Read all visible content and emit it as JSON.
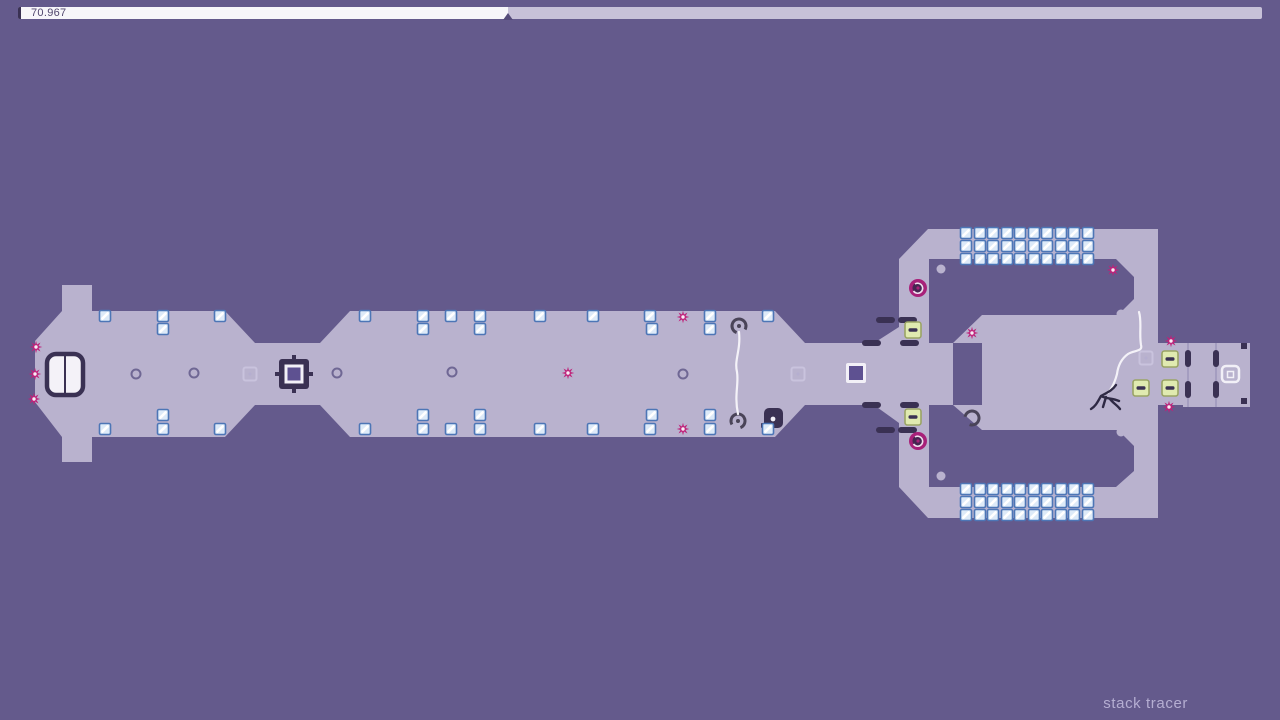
{
  "hud": {
    "timer": "70.967",
    "progress": 0.394
  },
  "level_name": "stack tracer",
  "colors": {
    "bg": "#645a8c",
    "terrain": "#b9b2ce",
    "dark": "#3a3153",
    "bar_fill": "#f7f6fa",
    "bar_rest": "#c7c1d8",
    "bar_text": "#51476e",
    "gold_fill": "#ddeaf8",
    "gold_border": "#4d76b6",
    "mine": "#bf2179",
    "green_fill": "#e0eab0",
    "green_border": "#9aa465",
    "drone_ring": "#a82079",
    "drone_core": "#452551",
    "trail": "#f4f2f8",
    "ninja": "#2e2944",
    "faint": "#c9c3dd",
    "ring_inner": "#5e5191",
    "name_color": "#b5aed2"
  },
  "entities": {
    "gold": [
      [
        105,
        316
      ],
      [
        163,
        316
      ],
      [
        220,
        316
      ],
      [
        365,
        316
      ],
      [
        423,
        316
      ],
      [
        451,
        316
      ],
      [
        480,
        316
      ],
      [
        540,
        316
      ],
      [
        593,
        316
      ],
      [
        650,
        316
      ],
      [
        710,
        316
      ],
      [
        768,
        316
      ],
      [
        163,
        329
      ],
      [
        423,
        329
      ],
      [
        480,
        329
      ],
      [
        652,
        329
      ],
      [
        710,
        329
      ],
      [
        105,
        429
      ],
      [
        163,
        429
      ],
      [
        220,
        429
      ],
      [
        365,
        429
      ],
      [
        423,
        429
      ],
      [
        451,
        429
      ],
      [
        480,
        429
      ],
      [
        540,
        429
      ],
      [
        593,
        429
      ],
      [
        650,
        429
      ],
      [
        710,
        429
      ],
      [
        768,
        429
      ],
      [
        163,
        415
      ],
      [
        423,
        415
      ],
      [
        480,
        415
      ],
      [
        652,
        415
      ],
      [
        710,
        415
      ],
      [
        966,
        233
      ],
      [
        980,
        233
      ],
      [
        993,
        233
      ],
      [
        1007,
        233
      ],
      [
        1020,
        233
      ],
      [
        1034,
        233
      ],
      [
        1047,
        233
      ],
      [
        1061,
        233
      ],
      [
        1074,
        233
      ],
      [
        1088,
        233
      ],
      [
        966,
        246
      ],
      [
        980,
        246
      ],
      [
        993,
        246
      ],
      [
        1007,
        246
      ],
      [
        1020,
        246
      ],
      [
        1034,
        246
      ],
      [
        1047,
        246
      ],
      [
        1061,
        246
      ],
      [
        1074,
        246
      ],
      [
        1088,
        246
      ],
      [
        966,
        259
      ],
      [
        980,
        259
      ],
      [
        993,
        259
      ],
      [
        1007,
        259
      ],
      [
        1020,
        259
      ],
      [
        1034,
        259
      ],
      [
        1047,
        259
      ],
      [
        1061,
        259
      ],
      [
        1074,
        259
      ],
      [
        1088,
        259
      ],
      [
        966,
        489
      ],
      [
        980,
        489
      ],
      [
        993,
        489
      ],
      [
        1007,
        489
      ],
      [
        1020,
        489
      ],
      [
        1034,
        489
      ],
      [
        1047,
        489
      ],
      [
        1061,
        489
      ],
      [
        1074,
        489
      ],
      [
        1088,
        489
      ],
      [
        966,
        502
      ],
      [
        980,
        502
      ],
      [
        993,
        502
      ],
      [
        1007,
        502
      ],
      [
        1020,
        502
      ],
      [
        1034,
        502
      ],
      [
        1047,
        502
      ],
      [
        1061,
        502
      ],
      [
        1074,
        502
      ],
      [
        1088,
        502
      ],
      [
        966,
        515
      ],
      [
        980,
        515
      ],
      [
        993,
        515
      ],
      [
        1007,
        515
      ],
      [
        1020,
        515
      ],
      [
        1034,
        515
      ],
      [
        1047,
        515
      ],
      [
        1061,
        515
      ],
      [
        1074,
        515
      ],
      [
        1088,
        515
      ]
    ],
    "mines": [
      [
        36,
        347
      ],
      [
        35,
        374
      ],
      [
        34,
        399
      ],
      [
        568,
        373
      ],
      [
        683,
        317
      ],
      [
        683,
        429
      ],
      [
        972,
        333
      ],
      [
        1113,
        270
      ],
      [
        1171,
        341
      ],
      [
        1169,
        407
      ]
    ],
    "circle_switches": [
      [
        136,
        374
      ],
      [
        194,
        373
      ],
      [
        337,
        373
      ],
      [
        452,
        372
      ],
      [
        683,
        374
      ]
    ],
    "faint_switches": [
      [
        250,
        374
      ],
      [
        798,
        374
      ],
      [
        1146,
        358
      ]
    ],
    "green_switches": [
      [
        913,
        330
      ],
      [
        913,
        417
      ],
      [
        1141,
        388
      ],
      [
        1170,
        359
      ],
      [
        1170,
        388
      ]
    ],
    "pills_h": [
      [
        862,
        340
      ],
      [
        900,
        340
      ],
      [
        862,
        402
      ],
      [
        900,
        402
      ],
      [
        876,
        317
      ],
      [
        898,
        317
      ],
      [
        876,
        427
      ],
      [
        898,
        427
      ]
    ],
    "pills_v": [
      [
        1185,
        350
      ],
      [
        1185,
        381
      ],
      [
        1213,
        350
      ],
      [
        1213,
        381
      ]
    ],
    "drones": [
      [
        918,
        288
      ],
      [
        918,
        441
      ]
    ],
    "c_rings": [
      [
        739,
        326
      ],
      [
        738,
        421
      ],
      [
        972,
        418
      ]
    ],
    "nubs": [
      [
        941,
        269
      ],
      [
        941,
        476
      ],
      [
        1121,
        314
      ],
      [
        1121,
        432
      ]
    ],
    "trails": [
      "M739 332 C741 350 734 360 737 372 C739 384 734 395 738 414",
      "M1139 312 C1142 322 1139 333 1141 345 C1143 352 1134 350 1128 354 C1121 359 1118 366 1117 374 C1115 382 1112 388 1108 393"
    ],
    "ninja_path": "M1116 385 C1112 391 1106 393 1101 396 M1101 396 C1106 399 1113 398 1119 401 M1101 396 C1098 401 1096 406 1091 409 M1106 397 L1103 407 M1110 399 C1113 403 1117 405 1120 409"
  }
}
